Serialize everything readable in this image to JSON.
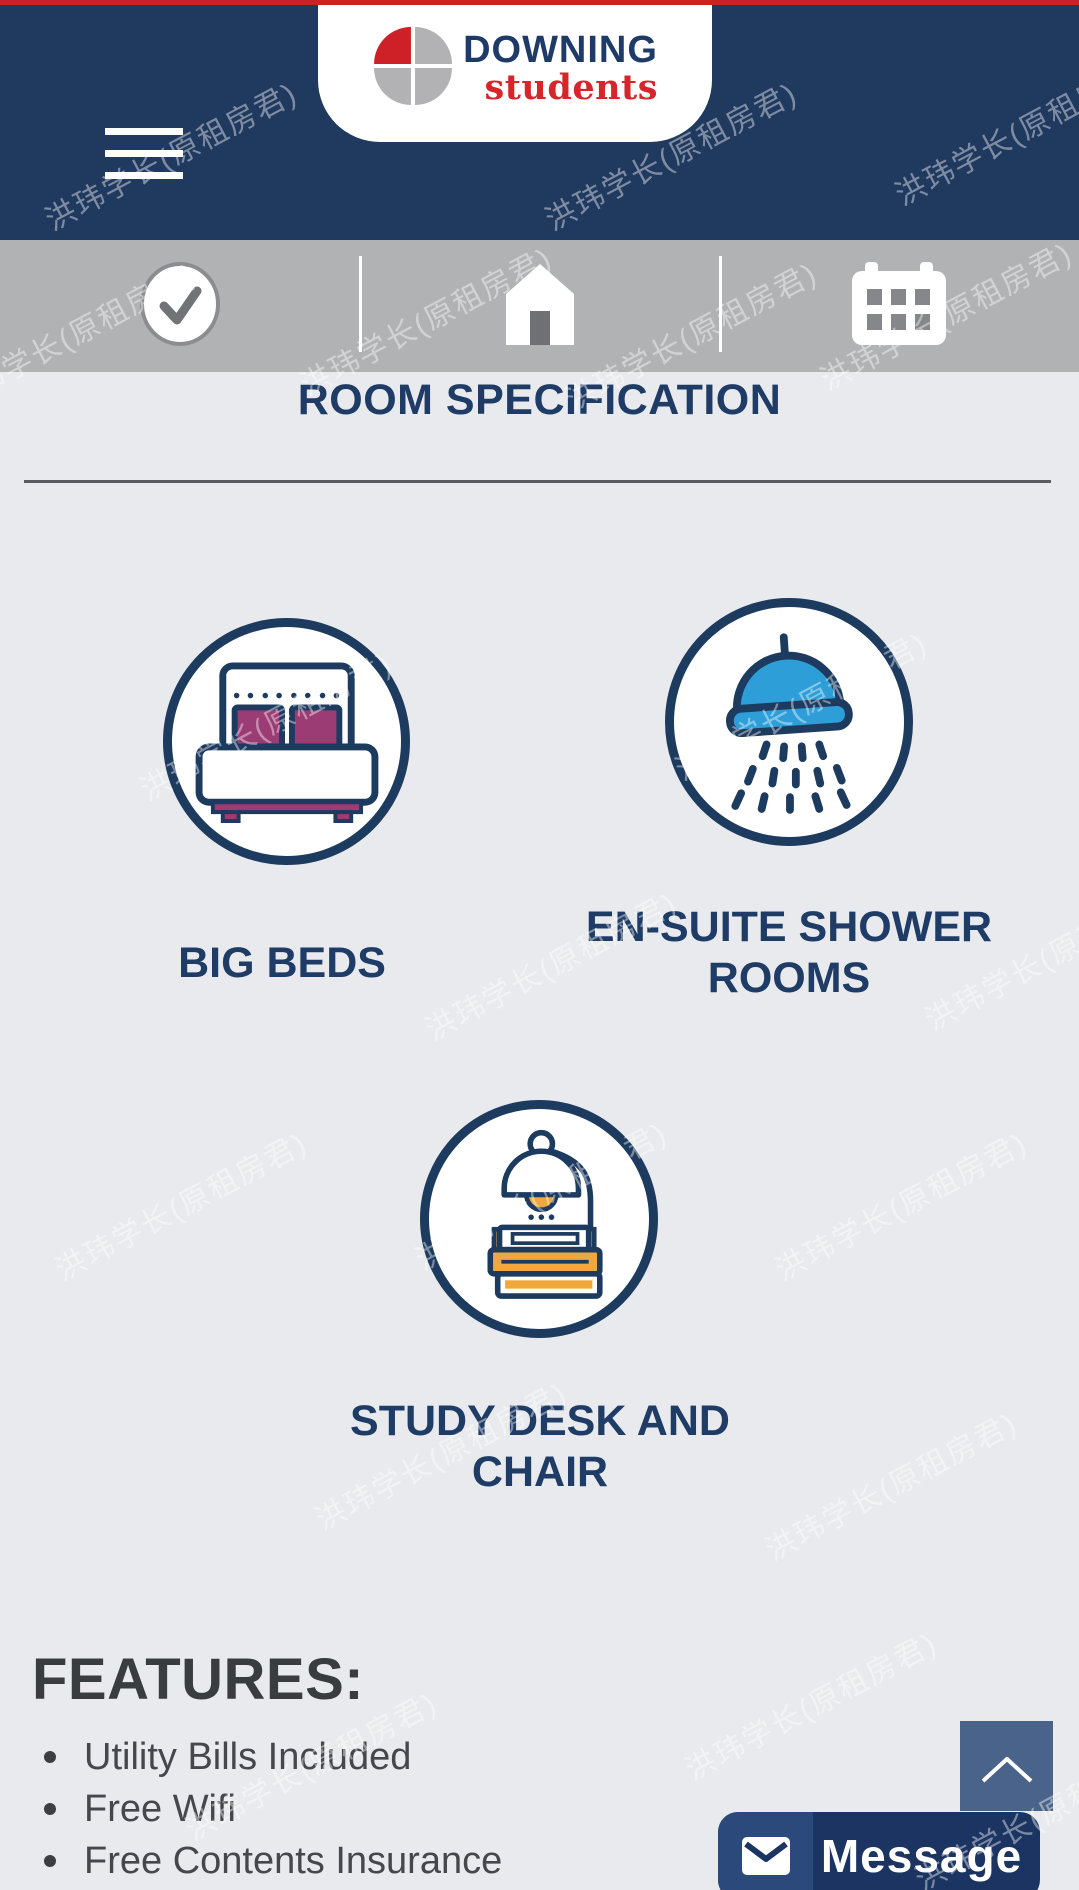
{
  "watermark": {
    "text": "洪玮学长(原租房君)"
  },
  "header": {
    "logo": {
      "line1": "DOWNING",
      "line2": "students"
    },
    "menu_icon": "hamburger-icon"
  },
  "toolbar": {
    "items": [
      {
        "icon": "check-circle-icon"
      },
      {
        "icon": "home-icon"
      },
      {
        "icon": "calendar-icon"
      }
    ]
  },
  "page": {
    "title": "ROOM SPECIFICATION"
  },
  "room_features": [
    {
      "icon": "bed-icon",
      "label": "BIG BEDS"
    },
    {
      "icon": "shower-icon",
      "label": "EN-SUITE SHOWER ROOMS"
    },
    {
      "icon": "desk-lamp-books-icon",
      "label": "STUDY DESK AND CHAIR"
    }
  ],
  "features": {
    "heading": "FEATURES:",
    "items": [
      "Utility Bills Included",
      "Free Wifi",
      "Free Contents Insurance"
    ]
  },
  "message_button": {
    "label": "Message",
    "icon": "envelope-icon"
  },
  "scroll_top_button": {
    "icon": "chevron-up-icon"
  },
  "colors": {
    "brand_navy": "#20395f",
    "brand_red": "#ce2027",
    "toolbar_gray": "#b1b2b4",
    "background": "#e9eaed",
    "icon_blue": "#2e9ed8",
    "icon_magenta": "#9c3c74",
    "icon_orange": "#efa73e",
    "slate_button": "#4a638b"
  }
}
